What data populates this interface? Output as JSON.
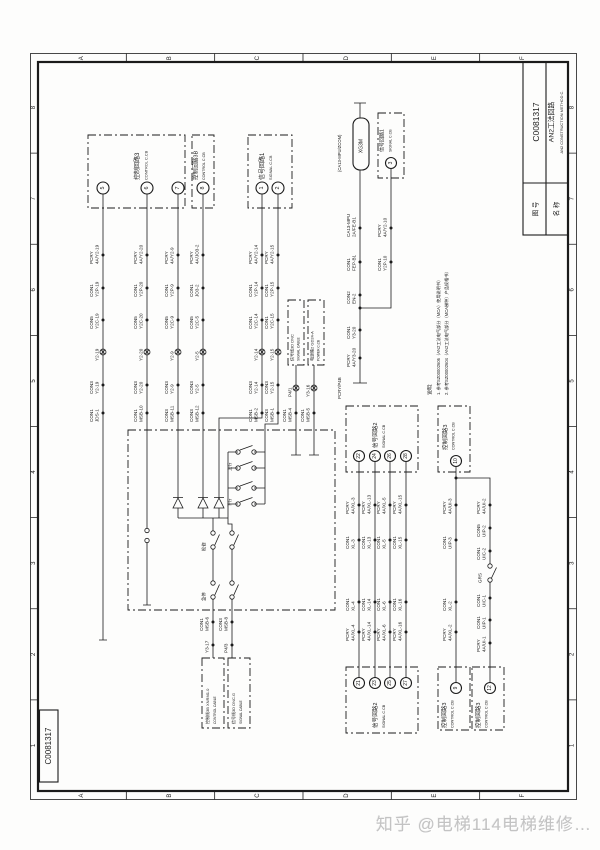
{
  "watermark": "知乎 @电梯114电梯维修…",
  "sheet": {
    "corner_code": "C0081317",
    "zone_letters": [
      "A",
      "B",
      "C",
      "D",
      "E",
      "F"
    ],
    "zone_numbers": [
      "8",
      "7",
      "6",
      "5",
      "4",
      "3",
      "2",
      "1"
    ],
    "title_block": {
      "no_label": "图 号",
      "no_value": "C0081317",
      "name_label": "名 称",
      "name_cn": "AN2工法回路",
      "name_en": "AN2 CONSTRUCTION METHOD C."
    }
  },
  "notes": {
    "heading": "说明:",
    "lines": [
      "1. 参考SZ00002606（AN2工法电气部分（MCA）使用说明书）",
      "2. 参考SZ00002604（AN2工法电气部分（MCA梯种）产品规格书）"
    ]
  },
  "blocks": {
    "ctrl3_top": {
      "cn": "控制回路3",
      "en": "CONTROL C.CB",
      "terminals": [
        "5",
        "6",
        "7"
      ]
    },
    "ctrl3b_top": {
      "cn": "控制回路3B",
      "en": "CONTROL C.CB",
      "terminals": [
        "8"
      ]
    },
    "sig1_top": {
      "cn": "信号回路1",
      "en": "SIGNAL C.CB",
      "terminals": [
        "1",
        "2"
      ]
    },
    "sig1_right": {
      "cn": "信号回路1",
      "en": "SIGNAL C.CB",
      "terminals": [
        "3"
      ]
    },
    "sig2_top": {
      "cn": "信号回路2",
      "en": "SIGNAL C.CB",
      "terminals": [
        "22",
        "24",
        "26",
        "28"
      ]
    },
    "sig2_bottom": {
      "cn": "信号回路2",
      "en": "SIGNAL C.CB",
      "terminals": [
        "21",
        "23",
        "25",
        "27"
      ]
    },
    "ctrl3_rtop": {
      "cn": "控制回路3",
      "en": "CONTROL C.CB",
      "terminals": [
        "10"
      ]
    },
    "ctrl3_rbot1": {
      "cn": "控制回路3",
      "en": "CONTROL C.CB",
      "terminals": [
        "9"
      ]
    },
    "ctrl3_rbot2": {
      "cn": "控制回路3",
      "en": "CONTROL C.CB",
      "terminals": [
        "12"
      ]
    },
    "cable_sig3d": {
      "cn": "信号线3D DNC",
      "en": "SIGNAL CABLE"
    },
    "cable_pwr2": {
      "cn": "电源箱2 GD24-A",
      "en": "POWER C.CB"
    },
    "cable_ctrl3b": {
      "cn": "控制线3B XNRM1.0",
      "en": "CONTROL CABLE"
    },
    "cable_sig3dg": {
      "cn": "信号线3D DNC.G",
      "en": "SIGNAL CABLE"
    }
  },
  "columns": {
    "c5": {
      "labels": [
        {
          "n": "PCRY",
          "v": "4A/Y2-19"
        },
        {
          "n": "CON1",
          "v": "Y2P-19"
        },
        {
          "n": "CON5",
          "v": "Y2C-19"
        },
        {
          "v": "Y2-19"
        },
        {
          "n": "CON3",
          "v": "Y2-19"
        },
        {
          "n": "CON1",
          "v": "JDS-1"
        }
      ]
    },
    "c6": {
      "labels": [
        {
          "n": "PCRY",
          "v": "4A/Y2-20"
        },
        {
          "n": "CON1",
          "v": "Y2P-20"
        },
        {
          "n": "CON5",
          "v": "Y2C-20"
        },
        {
          "v": "Y2-20"
        },
        {
          "n": "CON3",
          "v": "Y2-20"
        },
        {
          "n": "CON1",
          "v": "MSB-10"
        }
      ]
    },
    "c7": {
      "labels": [
        {
          "n": "PCRY",
          "v": "4A/Y2-9"
        },
        {
          "n": "CON1",
          "v": "Y2P-9"
        },
        {
          "n": "CON5",
          "v": "Y2C-9"
        },
        {
          "v": "Y2-9"
        },
        {
          "n": "CON3",
          "v": "Y2-9"
        },
        {
          "n": "CON3",
          "v": "MSB-11"
        }
      ]
    },
    "c8": {
      "labels": [
        {
          "n": "PCRY",
          "v": "4A/JO3-2"
        },
        {
          "n": "CON1",
          "v": "JO3-2"
        },
        {
          "n": "CON5",
          "v": "Y2C-5"
        },
        {
          "v": "Y2-5"
        },
        {
          "n": "CON3",
          "v": "Y2-5"
        },
        {
          "n": "CON3",
          "v": "MSB-12"
        }
      ]
    },
    "c1": {
      "labels": [
        {
          "n": "PCRY",
          "v": "4A/Y2-14"
        },
        {
          "n": "CON1",
          "v": "Y2P-14"
        },
        {
          "n": "CON1",
          "v": "Y2C-14"
        },
        {
          "v": "Y2-14"
        },
        {
          "n": "CON3",
          "v": "Y2-14"
        },
        {
          "n": "CON1",
          "v": "MSB-2"
        }
      ]
    },
    "c2": {
      "labels": [
        {
          "n": "PCRY",
          "v": "4A/Y2-15"
        },
        {
          "n": "CON1",
          "v": "Y2P-15"
        },
        {
          "n": "CON1",
          "v": "Y2C-15"
        },
        {
          "v": "Y2-15"
        },
        {
          "n": "CON3",
          "v": "Y2-15"
        },
        {
          "n": "CON3",
          "v": "MSB-1"
        }
      ]
    }
  },
  "aux": {
    "a1": {
      "labels": [
        {
          "v": "P4/1"
        },
        {
          "n": "CON1",
          "v": "MSB-4"
        }
      ]
    },
    "a2": {
      "labels": [
        {
          "v": "Y3-16"
        },
        {
          "n": "CON1",
          "v": "MSB-5"
        }
      ]
    }
  },
  "right": {
    "net": "(CA13-MPU/ZCOM)",
    "connector": "XG3M",
    "mpu": [
      {
        "n": "CA13-MPU",
        "v": "2A/FE-B1"
      },
      {
        "n": "CON1",
        "v": "FEP-B1"
      },
      {
        "n": "CON2",
        "v": "EN-2"
      }
    ],
    "sig3": [
      {
        "n": "PCRY",
        "v": "4A/Y2-10"
      },
      {
        "n": "CON1",
        "v": "Y2P-10"
      }
    ],
    "merge": [
      {
        "n": "CON1",
        "v": "Y3-20"
      },
      {
        "n": "PCRY",
        "v": "4A/Y3-20"
      }
    ],
    "end_label": "PCRY/P4B"
  },
  "sig2": {
    "w22": [
      {
        "n": "PCRY",
        "v": "4A/XL-3"
      },
      {
        "n": "CON1",
        "v": "XL-3"
      },
      {
        "n": "CON1",
        "v": "XL-4"
      },
      {
        "n": "PCRY",
        "v": "4A/XL-4"
      }
    ],
    "w24": [
      {
        "n": "PCRY",
        "v": "4A/XL-13"
      },
      {
        "n": "CON1",
        "v": "XL-13"
      },
      {
        "n": "CON1",
        "v": "XL-14"
      },
      {
        "n": "PCRY",
        "v": "4A/XL-14"
      }
    ],
    "w26": [
      {
        "n": "PCRY",
        "v": "4A/XL-5"
      },
      {
        "n": "CON1",
        "v": "XL-5"
      },
      {
        "n": "CON1",
        "v": "XL-6"
      },
      {
        "n": "PCRY",
        "v": "4A/XL-6"
      }
    ],
    "w28": [
      {
        "n": "PCRY",
        "v": "4A/XL-15"
      },
      {
        "n": "CON1",
        "v": "XL-15"
      },
      {
        "n": "CON1",
        "v": "XL-16"
      },
      {
        "n": "PCRY",
        "v": "4A/XL-16"
      }
    ]
  },
  "ctrl3r": {
    "w10": [
      {
        "n": "PCRY",
        "v": "4A/UI-3"
      },
      {
        "n": "CON1",
        "v": "UIP-3"
      },
      {
        "n": "CON1",
        "v": "XL-2"
      },
      {
        "n": "PCRY",
        "v": "4A/XL-2"
      }
    ],
    "w12": [
      {
        "n": "PCRY",
        "v": "4A/UI-2"
      },
      {
        "n": "CON5",
        "v": "UIP-2"
      },
      {
        "n": "CON1",
        "v": "UIC-2"
      },
      {
        "n": "CON1",
        "v": "UIC-1"
      },
      {
        "n": "CON1",
        "v": "UIP-1"
      },
      {
        "n": "PCRY",
        "v": "4A/UI-1"
      }
    ],
    "relay": "GRS"
  },
  "machine": {
    "sw_up": "上行",
    "sw_down": "下行",
    "sw_insp": "检修",
    "sw_stop": "急停"
  },
  "exits": {
    "e1": [
      {
        "n": "CON1",
        "v": "MSB-6"
      },
      {
        "v": "Y3-17"
      }
    ],
    "e2": [
      {
        "n": "CON3",
        "v": "MSB-8"
      },
      {
        "v": "P4/3"
      }
    ]
  }
}
